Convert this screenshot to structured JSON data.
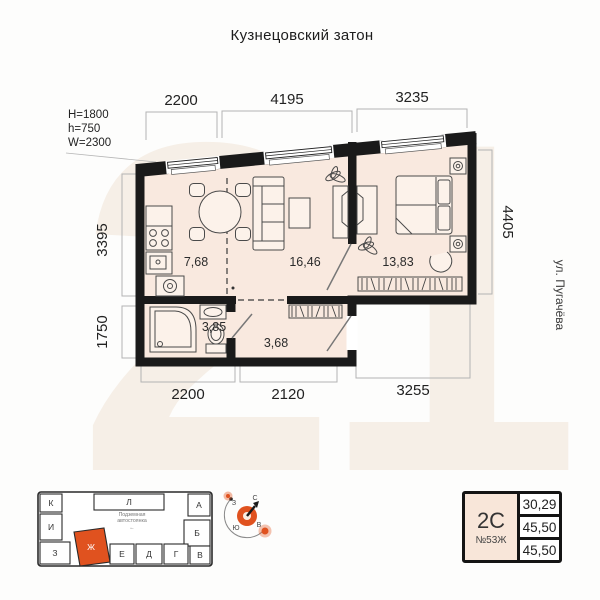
{
  "title": "Кузнецовский затон",
  "watermark": "21",
  "specs": {
    "lines": [
      "H=1800",
      "h=750",
      "W=2300"
    ]
  },
  "dimensions": {
    "top": [
      "2200",
      "4195",
      "3235"
    ],
    "left": [
      "3395",
      "1750"
    ],
    "right": [
      "4405"
    ],
    "bottom": [
      "2200",
      "2120",
      "3255"
    ]
  },
  "rooms": {
    "kitchen": "7,68",
    "living": "16,46",
    "bedroom": "13,83",
    "bathroom": "3,85",
    "hallway": "3,68"
  },
  "street": "ул. Пугачёва",
  "site_plan": {
    "sections": {
      "k": "К",
      "l": "Л",
      "a": "А",
      "i": "И",
      "b": "Б",
      "z": "З",
      "zh": "Ж",
      "e": "Е",
      "d": "Д",
      "g": "Г",
      "v": "В"
    },
    "highlighted": "Ж",
    "parking_line1": "Подземная",
    "parking_line2": "автостоянка",
    "parking_arrow": "←"
  },
  "compass": {
    "north": "С",
    "south": "Ю",
    "west": "З",
    "east": "В"
  },
  "info_card": {
    "type": "2С",
    "unit": "№53Ж",
    "values": [
      "30,29",
      "45,50",
      "45,50"
    ]
  },
  "colors": {
    "accent": "#e0521f",
    "floor": "#f9e9df",
    "wall": "#1a1a1a",
    "card_fill": "#f8e6d9",
    "watermark": "#f6efe7"
  }
}
